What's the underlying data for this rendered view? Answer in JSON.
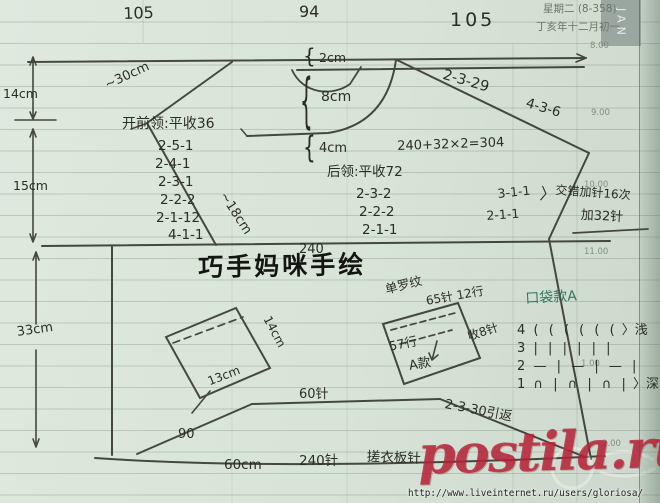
{
  "page": {
    "weekday_line": "星期二  (8-358)",
    "lunar_date": "丁亥年十二月初一",
    "month_tab": "JAN",
    "hours": {
      "h8": "8.00",
      "h9": "9.00",
      "h10": "10.00",
      "h11": "11.00",
      "h1": "1.00",
      "h2": "2.00"
    }
  },
  "widths": {
    "top_left": "105",
    "top_mid": "94",
    "top_right": "105"
  },
  "dims": {
    "brace": "{",
    "shoulder_drop": "14cm",
    "armhole_depth": "15cm",
    "body_length": "33cm",
    "sleeve_top": "~30cm",
    "side_slant": "~18cm",
    "neck_band": "2cm",
    "neck_depth": "8cm",
    "neck_below": "4cm",
    "chest_sts": "240",
    "chest_calc": "240+32×2=304"
  },
  "neck_front": {
    "title": "开前领:平收36",
    "rows": [
      "2-5-1",
      "2-4-1",
      "2-3-1",
      "2-2-2",
      "2-1-12",
      "4-1-1"
    ]
  },
  "neck_back": {
    "title": "后领:平收72",
    "rows": [
      "2-3-2",
      "2-2-2",
      "2-1-1"
    ]
  },
  "raglan": {
    "left": "2-3-29",
    "right": "4-3-6"
  },
  "side_dec": {
    "a": "3-1-1",
    "b": "2-1-1"
  },
  "increase": {
    "bracket": "〉",
    "note": "交错加针16次",
    "total": "加32针"
  },
  "signature": "巧手妈咪手绘",
  "hem": {
    "inner_sts": "60针",
    "slant_rows": "90",
    "short_rows": "2-3-30引返",
    "width": "60cm",
    "sts": "240针",
    "stitch": "搓衣板针"
  },
  "pocket_left": {
    "height": "14cm",
    "width": "13cm"
  },
  "pocket_right": {
    "rib": "单罗纹",
    "cast_on": "65针 12行",
    "bind_off": "收8针",
    "rows": "57行",
    "style": "A款"
  },
  "pocket_chart": {
    "title": "口袋款A",
    "rows": [
      {
        "num": "4",
        "symbols": "( ( ( ( ( (",
        "note": "〉浅"
      },
      {
        "num": "3",
        "symbols": "| | | | | |",
        "note": ""
      },
      {
        "num": "2",
        "symbols": "— | — | — |",
        "note": ""
      },
      {
        "num": "1",
        "symbols": "∩ | ∩ | ∩ |",
        "note": "〉深"
      }
    ]
  },
  "watermark": {
    "site": "postila.ru",
    "url": "http://www.liveinternet.ru/users/gloriosa/"
  }
}
